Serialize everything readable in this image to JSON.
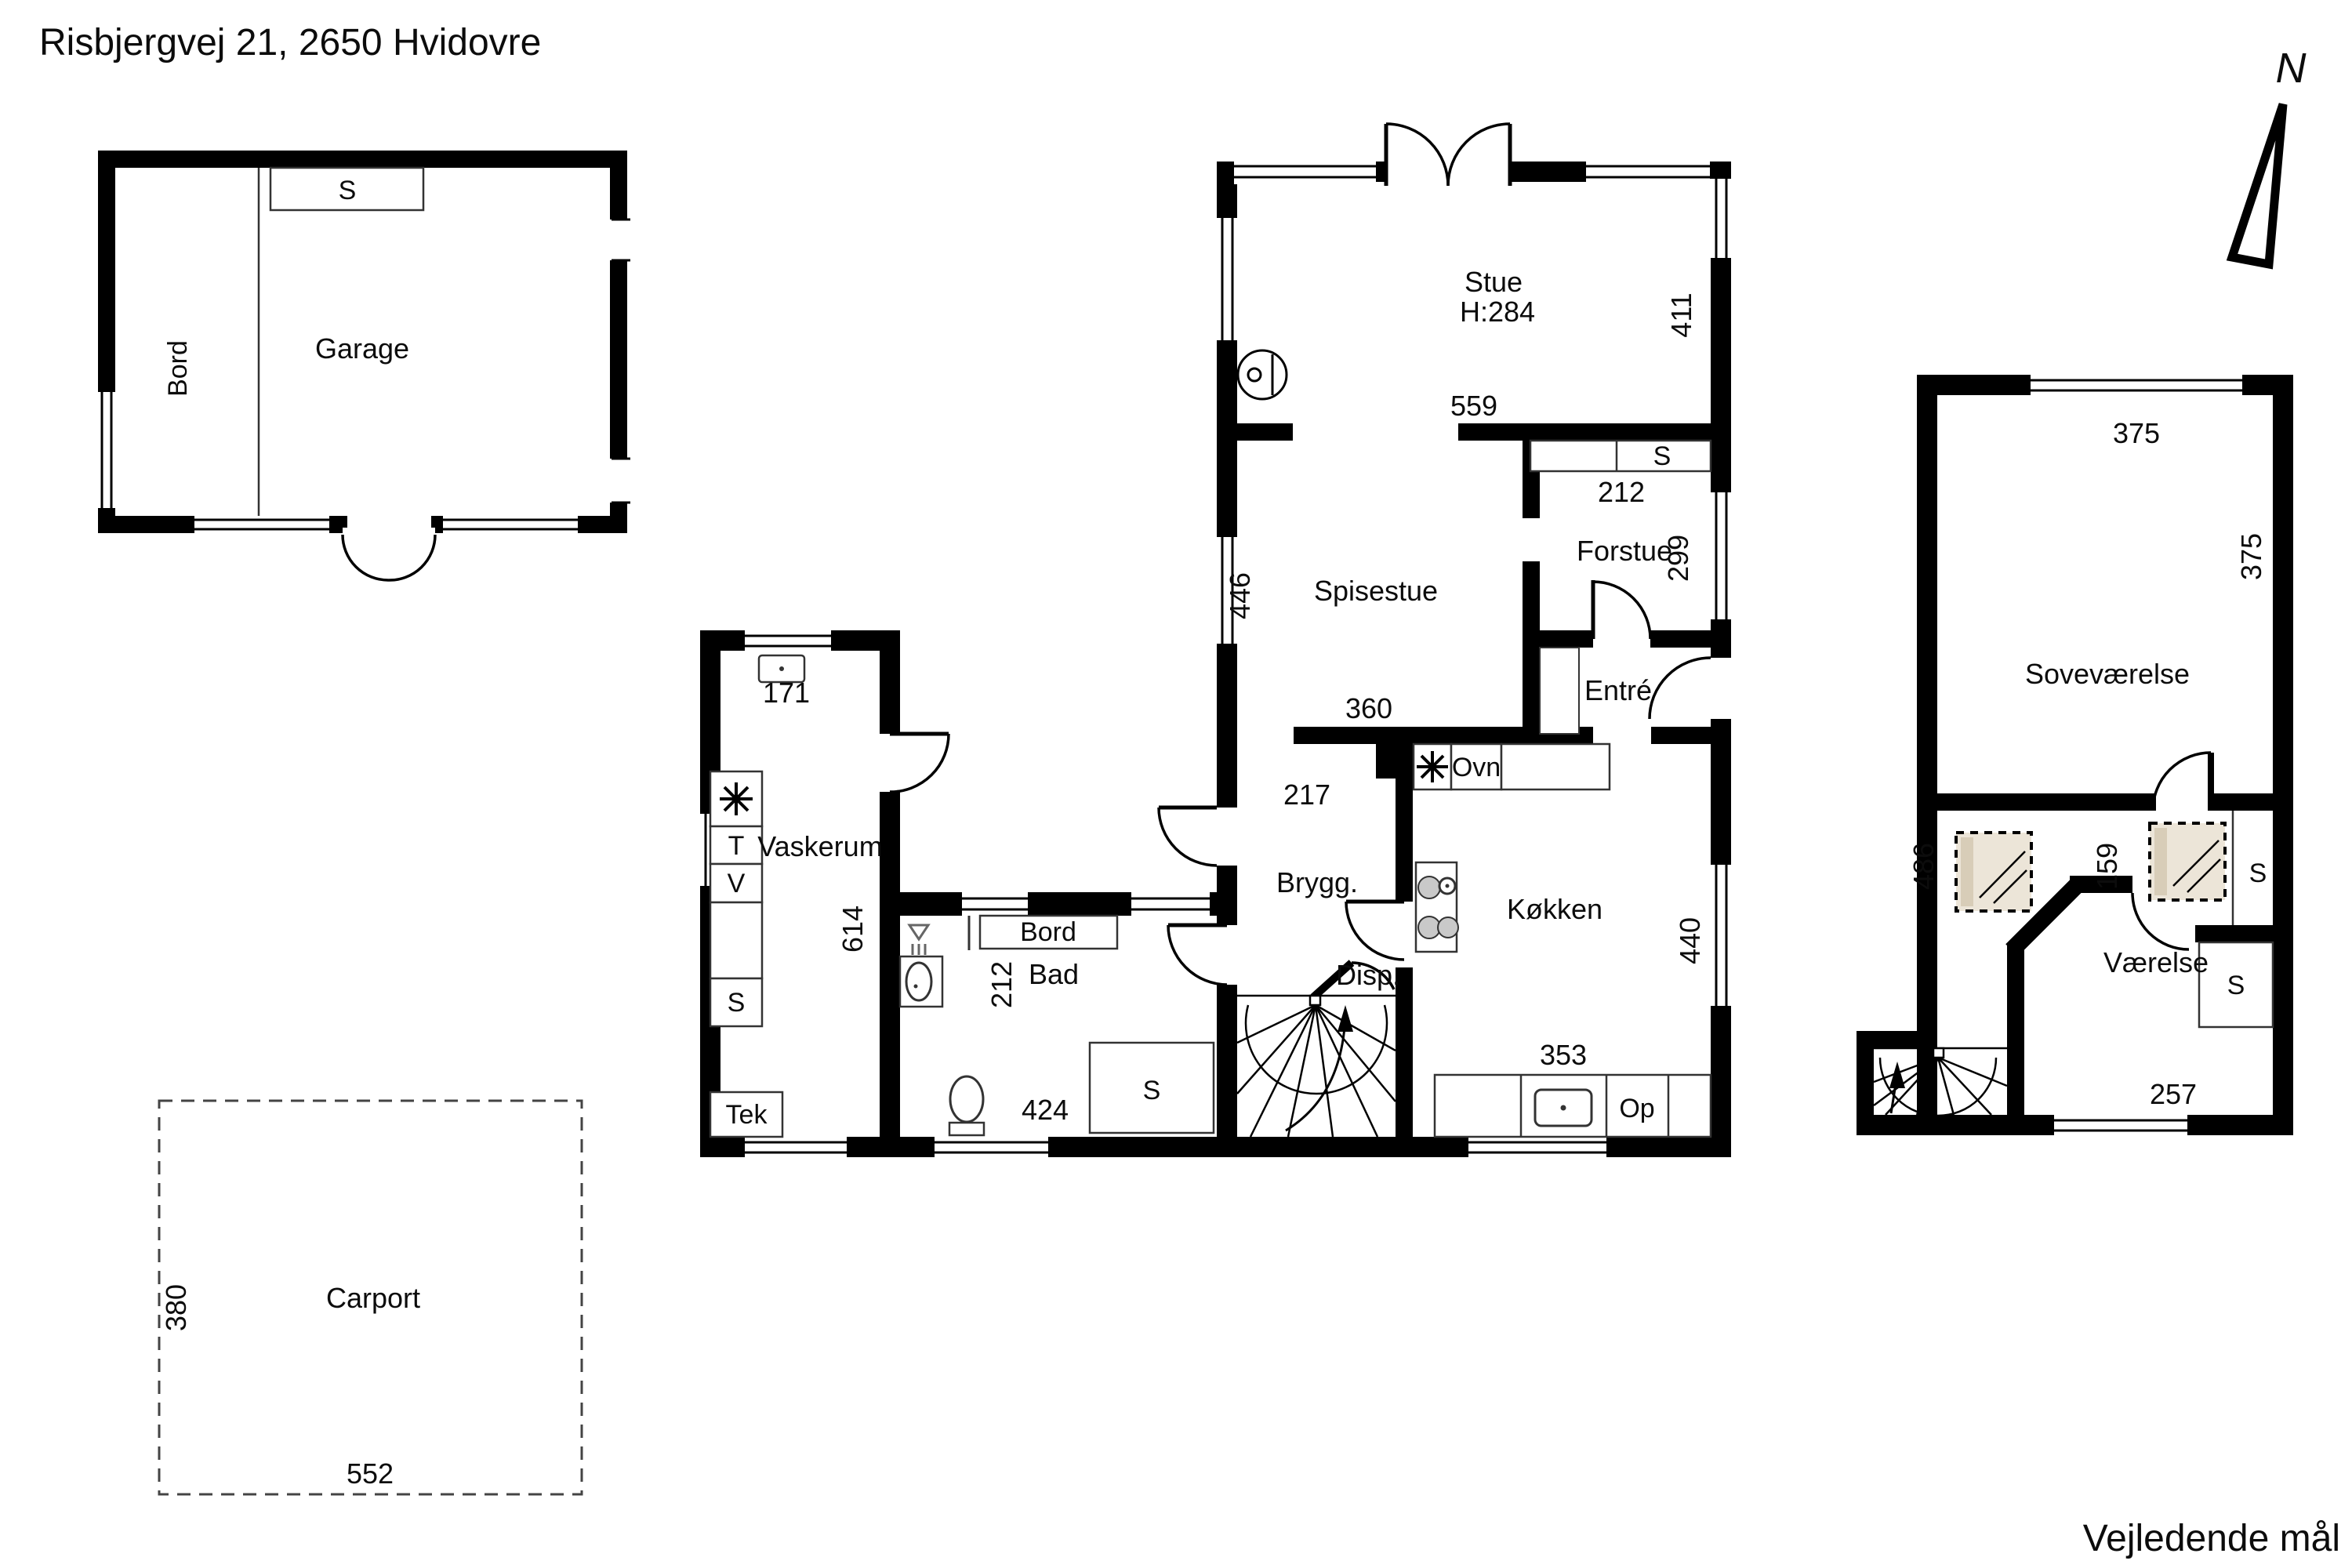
{
  "title": "Risbjergvej 21, 2650 Hvidovre",
  "footer": "Vejledende mål",
  "north_label": "N",
  "garage": {
    "name": "Garage",
    "closet": "S",
    "table": "Bord"
  },
  "carport": {
    "name": "Carport",
    "dim_left": "380",
    "dim_bottom": "552"
  },
  "ground_floor": {
    "stue": {
      "name": "Stue",
      "ceiling_height": "H:284",
      "dim_right": "411",
      "dim_opening": "559"
    },
    "spisestue": {
      "name": "Spisestue",
      "dim_left": "446",
      "dim_bottom": "360"
    },
    "forstue": {
      "name": "Forstue",
      "dim_right": "299",
      "closet": "S",
      "closet_dim": "212"
    },
    "entre": {
      "name": "Entré"
    },
    "brygg": {
      "name": "Brygg.",
      "dim_top": "217"
    },
    "disp": {
      "name": "Disp."
    },
    "kokken": {
      "name": "Køkken",
      "dim_right": "440",
      "dim_bottom": "353",
      "oven": "Ovn",
      "appliance": "Op"
    },
    "vaskerum": {
      "name": "Vaskerum",
      "dim_top": "171",
      "dim_side": "614",
      "appliance_star": "✳",
      "appliance_t": "T",
      "appliance_v": "V",
      "closet": "S",
      "tech": "Tek"
    },
    "bad": {
      "name": "Bad",
      "dim_side": "212",
      "dim_bottom": "424",
      "closet": "S",
      "table": "Bord"
    }
  },
  "first_floor": {
    "sovevaerelse": {
      "name": "Soveværelse",
      "dim_top": "375",
      "dim_right": "375"
    },
    "hall": {
      "dim": "159",
      "dim_left": "486",
      "closet_top": "S",
      "closet_bottom": "S"
    },
    "vaerelse": {
      "name": "Værelse",
      "dim_bottom": "257"
    }
  },
  "icons": {
    "north-arrow": "compass-needle",
    "wood-stove": "stove-circle",
    "stove-star": "8-spoke-asterisk",
    "cooktop": "four-burners",
    "sink": "basin-with-drain",
    "toilet": "wc",
    "shower": "floor-drain",
    "skylight": "roof-window",
    "stairs": "winder-stair-fan"
  },
  "colors": {
    "wall": "#000000",
    "background": "#ffffff",
    "skylight_fill": "#ece5d8",
    "skylight_edge": "#d8cdb8",
    "burner_fill": "#c9c9c9"
  }
}
